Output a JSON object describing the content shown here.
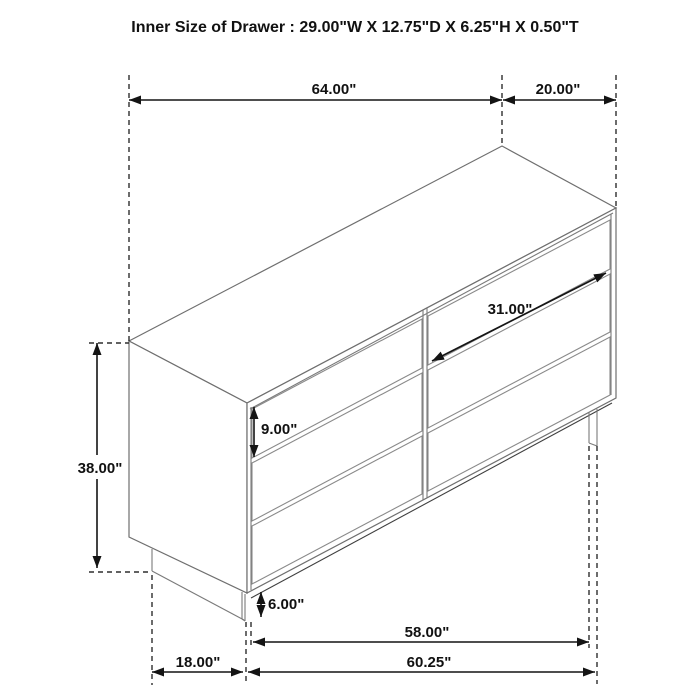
{
  "title": "Inner Size of Drawer : 29.00\"W X 12.75\"D X 6.25\"H X 0.50\"T",
  "dimensions": {
    "top_width": "64.00\"",
    "top_depth": "20.00\"",
    "drawer_width": "31.00\"",
    "drawer_height": "9.00\"",
    "overall_height": "38.00\"",
    "base_height": "6.00\"",
    "lower_width_inner": "58.00\"",
    "side_depth_bottom": "18.00\"",
    "lower_width_overall": "60.25\""
  },
  "colors": {
    "background": "#ffffff",
    "furniture_outline": "#6f6f6f",
    "dimension_line": "#141414",
    "label_text": "#111111"
  }
}
